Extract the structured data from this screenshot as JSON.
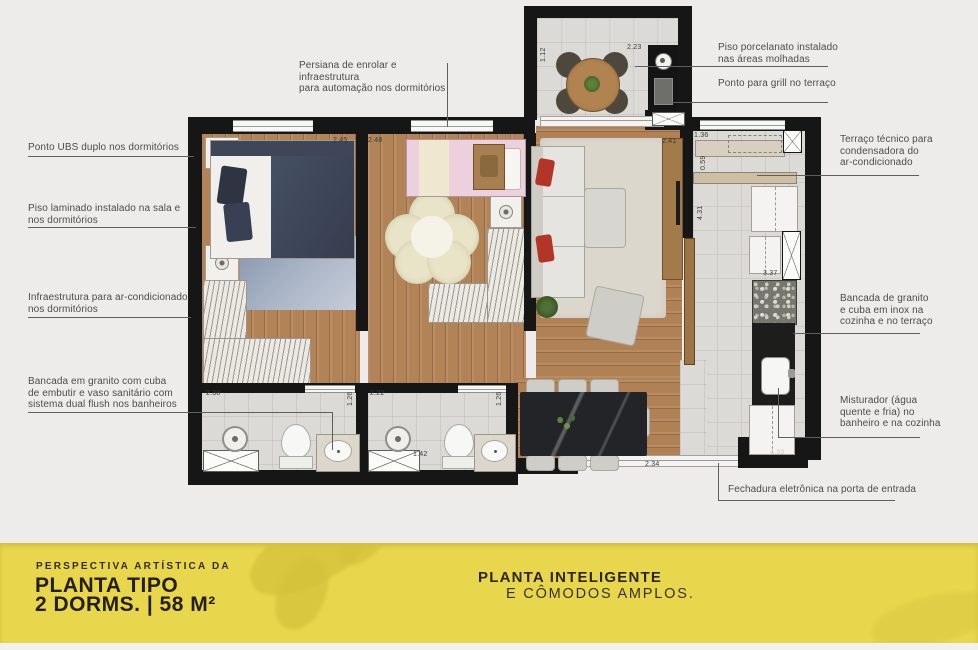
{
  "plan": {
    "callouts": {
      "top": "Persiana de enrolar e infraestrutura\npara automação nos dormitórios",
      "left": [
        "Ponto UBS duplo nos dormitórios",
        "Piso laminado instalado na sala e\nnos dormitórios",
        "Infraestrutura para ar-condicionado\nnos dormitórios",
        "Bancada em granito com cuba\nde embutir e vaso sanitário com\nsistema dual flush nos banheiros"
      ],
      "right": [
        "Piso porcelanato instalado\nnas áreas molhadas",
        "Ponto para grill no terraço",
        "Terraço técnico para\ncondensadora do\nar-condicionado",
        "Bancada de granito\ne cuba em inox na\ncozinha e no terraço",
        "Misturador (água\nquente e fria) no\nbanheiro e na cozinha",
        "Fechadura eletrônica na porta de entrada"
      ]
    },
    "dimensions": [
      "2.45",
      "2.48",
      "1.12",
      "2.23",
      "2.41",
      "1.36",
      "0.59",
      "4.31",
      "3.37",
      "2.38",
      "1.26",
      "2.22",
      "1.26",
      "1.42",
      "2.34",
      "4.39"
    ]
  },
  "footer": {
    "eyebrow": "PERSPECTIVA ARTÍSTICA DA",
    "title_line1": "PLANTA TIPO",
    "title_line2": "2 DORMS. | 58 M²",
    "tagline_line1": "PLANTA INTELIGENTE",
    "tagline_line2": "E CÔMODOS AMPLOS."
  },
  "colors": {
    "accent_yellow": "#e8d74d",
    "leaf_shadow": "#d4c23b",
    "wall_black": "#161616",
    "wood_floor": "#b28356",
    "tile_gray": "#dbdad6",
    "rug_blue": "#8d9ab2",
    "bed_navy": "#3e4658",
    "bed_pink": "#ecd0dd",
    "pillow_red": "#b23527"
  }
}
